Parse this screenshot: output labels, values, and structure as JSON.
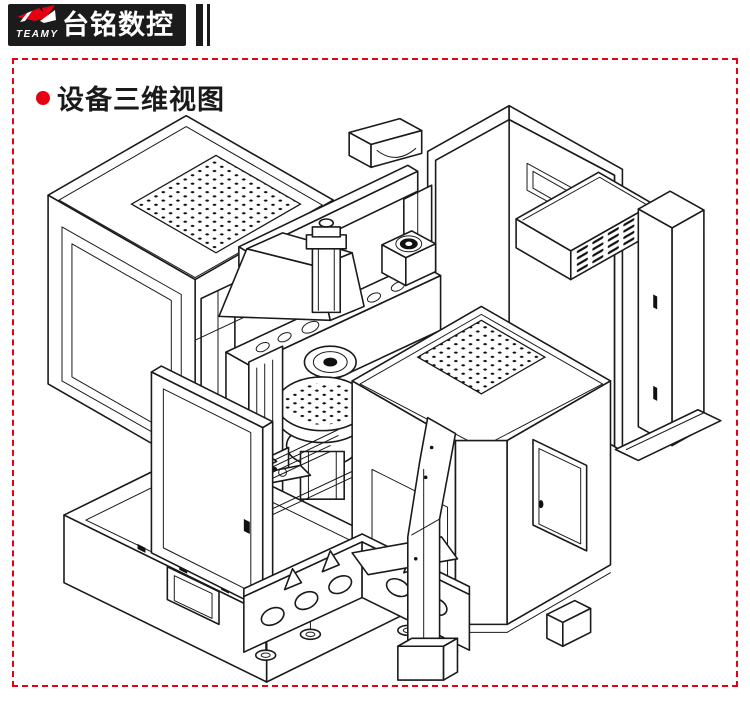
{
  "page": {
    "background": "#ffffff",
    "ink": "#1a1a1a",
    "accent_red": "#e60012",
    "bar_black": "#1b1b1b"
  },
  "header": {
    "brand_zh": "台铭数控",
    "brand_en": "TEAMY"
  },
  "section": {
    "title": "设备三维视图"
  },
  "figure": {
    "label": "设备三维视图",
    "type": "isometric-cad-line-drawing",
    "parts": [
      "left-enclosure-with-perforated-vent-top-and-open-door",
      "overhead-transfer-arm",
      "rear-electrical-cabinet-open-frame",
      "louvered-heat-exchanger-box",
      "right-side-cabinet-and-floor-rail",
      "cross-feed-beam-with-cylinder-and-motor",
      "rotary-work-table",
      "chip-bin-with-front-cutout",
      "front-enclosure-with-perforated-vent-top-and-access-door",
      "machine-base-plate-with-leveling-feet",
      "support-column-with-foot-block"
    ]
  }
}
